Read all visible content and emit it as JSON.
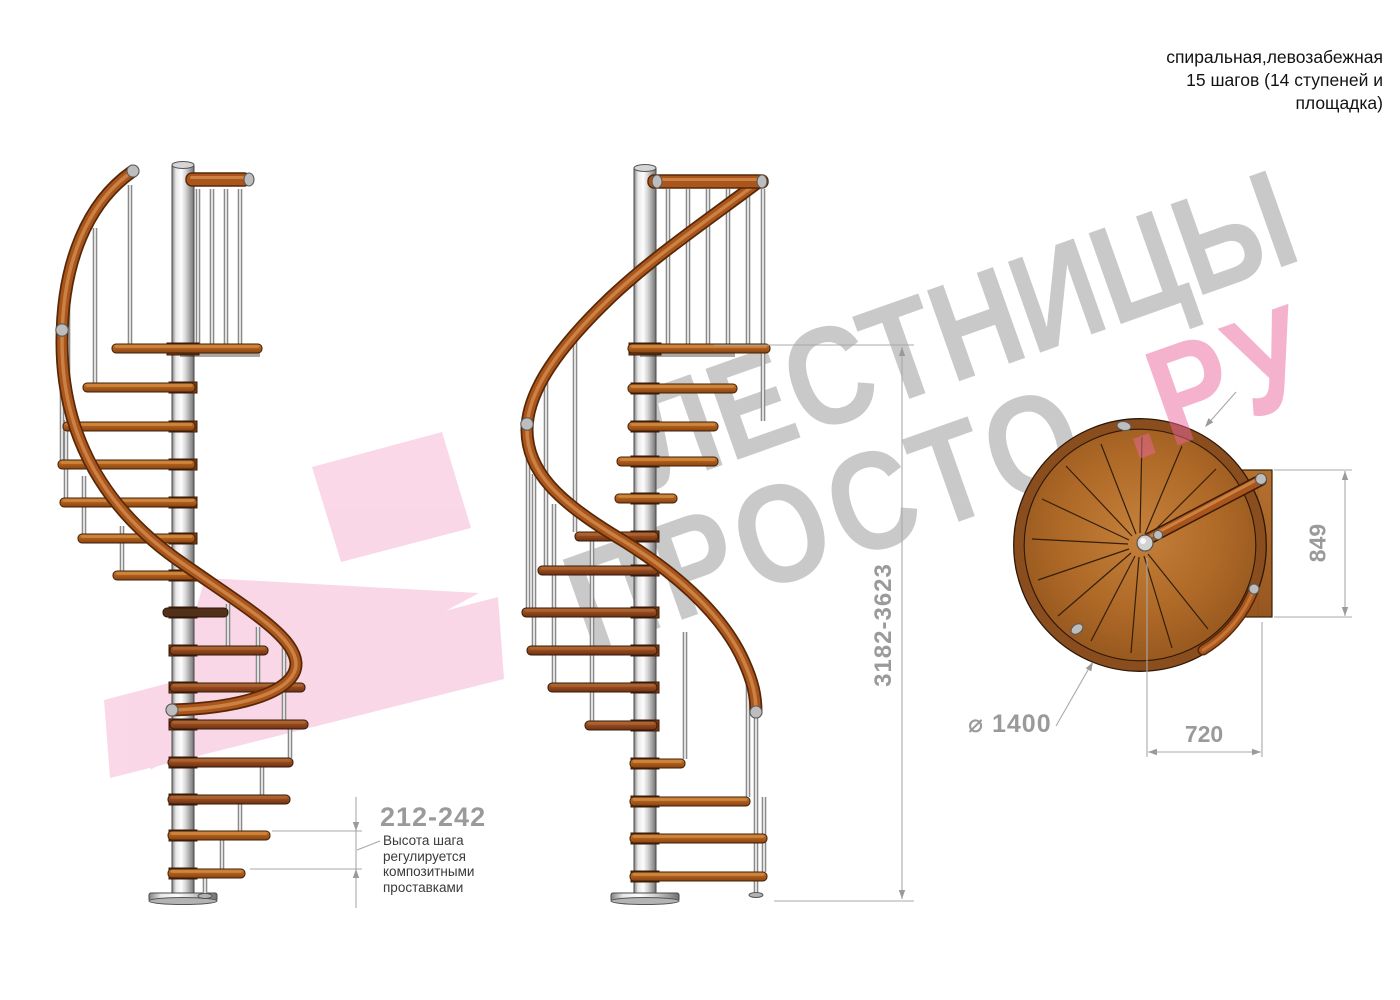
{
  "title": {
    "line1": "спиральная,левозабежная",
    "line2": "15 шагов (14 ступеней и",
    "line3": "площадка)"
  },
  "watermark": {
    "brand_top": "ЛЕСТНИЦЫ",
    "brand_bottom_gray": "ПРОСТО",
    "brand_bottom_pink": ".РУ",
    "gray_color": "#c9c9c9",
    "pink_color": "#ee85b5"
  },
  "dimensions": {
    "step_height": {
      "value": "212-242",
      "note": "Высота шага\nрегулируется\nкомпозитными\nпроставками"
    },
    "total_height": {
      "value": "3182-3623"
    },
    "landing_depth": {
      "value": "849"
    },
    "landing_width": {
      "value": "720"
    },
    "diameter": {
      "value": "⌀ 1400"
    }
  },
  "colors": {
    "wood_step": "#b5651f",
    "handrail": "#a9551c",
    "metal_pole": "#d9d9d9",
    "dimension_text": "#9a9a9a",
    "annotation_text": "#3a3a3a"
  }
}
